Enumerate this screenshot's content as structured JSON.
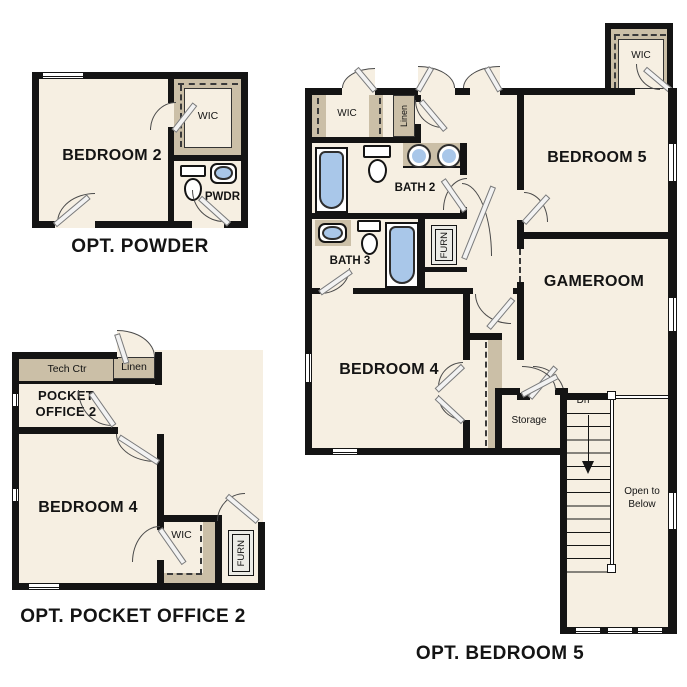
{
  "document_title": "Second floor option plans",
  "colors": {
    "floor_fill": "#f6efe2",
    "accent_tan": "#cbbfa7",
    "fixture_blue": "#a9c7e9",
    "wall_black": "#141414",
    "background": "#ffffff"
  },
  "plans": {
    "powder": {
      "caption": "OPT. POWDER",
      "rooms": {
        "bedroom2": "BEDROOM 2",
        "wic": "WIC",
        "pwdr": "PWDR"
      }
    },
    "pocket_office": {
      "caption": "OPT. POCKET OFFICE 2",
      "rooms": {
        "tech_ctr": "Tech Ctr",
        "linen": "Linen",
        "pocket_office": "POCKET OFFICE 2",
        "bedroom4": "BEDROOM 4",
        "wic": "WIC",
        "furn": "FURN"
      }
    },
    "bedroom5": {
      "caption": "OPT. BEDROOM 5",
      "rooms": {
        "wic_top": "WIC",
        "wic_hall": "WIC",
        "linen": "Linen",
        "bath2": "BATH 2",
        "bath3": "BATH 3",
        "furn": "FURN",
        "bedroom5": "BEDROOM 5",
        "gameroom": "GAMEROOM",
        "bedroom4": "BEDROOM 4",
        "storage": "Storage",
        "dn": "Dn",
        "open_to_below": "Open to Below"
      }
    }
  }
}
